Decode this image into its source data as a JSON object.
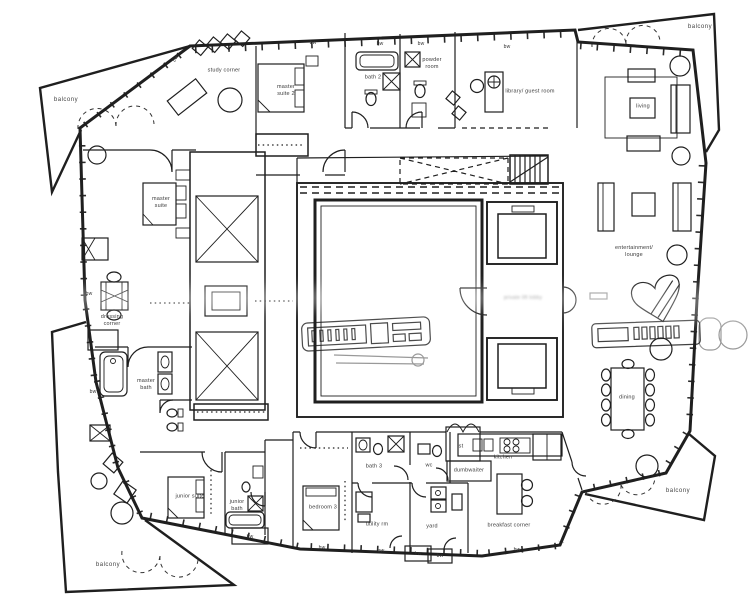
{
  "page": {
    "title": "apartment floor plan drawing"
  },
  "colors": {
    "line": "#1f1f1f",
    "background": "#ffffff",
    "label": "#3a3a3a",
    "watermark_gray": "#8a8a8a"
  },
  "labels": {
    "balcony": "balcony",
    "study_corner": "study corner",
    "master_suite_2": "master\nsuite 2",
    "bath_2": "bath 2",
    "powder_room": "powder\nroom",
    "library_guest_room": "library/ guest room",
    "living": "living",
    "master_suite": "master\nsuite",
    "entertainment_lounge": "entertainment/\nlounge",
    "dressing_corner": "dressing\ncorner",
    "master_bath": "master\nbath",
    "dining": "dining",
    "junior_suite": "junior suite",
    "junior_bath": "junior\nbath",
    "bedroom_3": "bedroom 3",
    "bath_3": "bath 3",
    "utility_rm": "utility rm",
    "wc": "wc",
    "yard": "yard",
    "st": "st",
    "dumbwaiter": "dumbwaiter",
    "kitchen": "kitchen",
    "breakfast_corner": "breakfast corner",
    "bw": "bw",
    "lift_lobby": "private lift lobby"
  }
}
